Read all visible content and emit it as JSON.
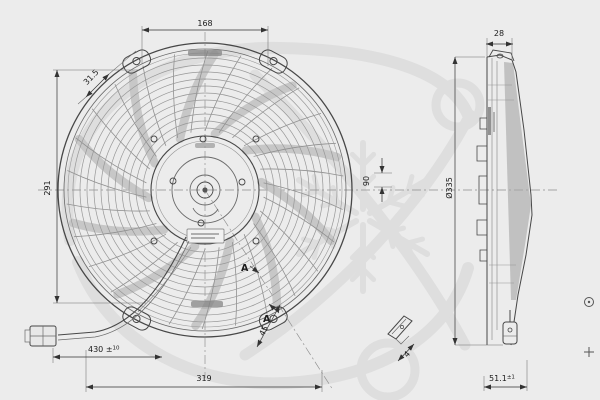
{
  "drawing_dimensions": {
    "top_width": "168",
    "tab_offset": "31.5",
    "left_height": "291",
    "hub_depth": "90",
    "shroud_depth": "28",
    "fan_diameter": "Ø335",
    "wire_length": "430 ±",
    "wire_length_tolerance": "10",
    "bottom_width": "319",
    "overall_depth": "51.1",
    "overall_depth_tolerance": "±1",
    "bracket_angle": "45",
    "bracket_gap": "4",
    "section_label": "A"
  }
}
